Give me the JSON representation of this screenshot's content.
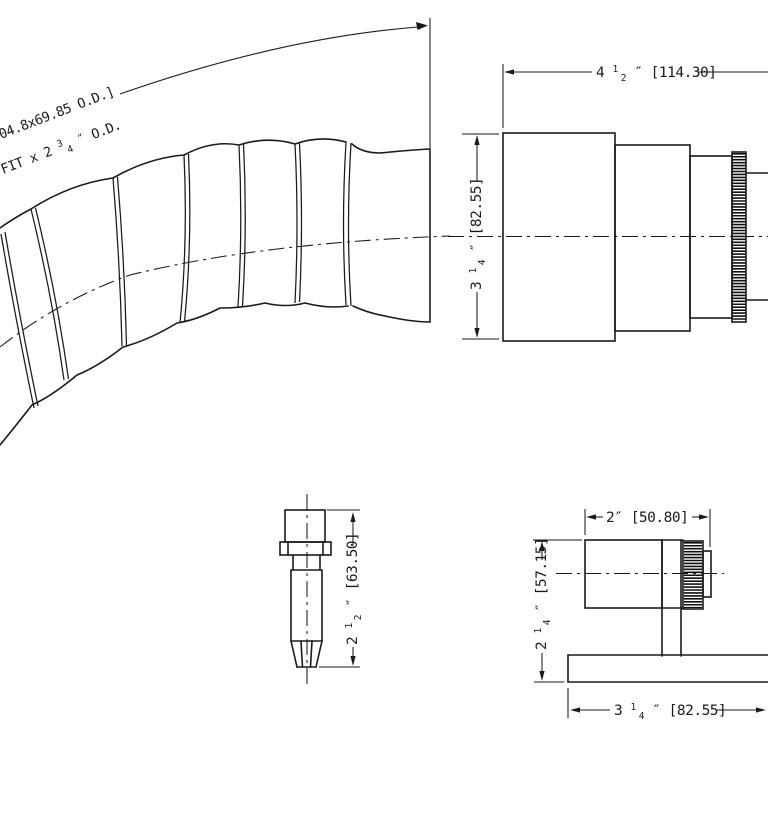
{
  "drawing": {
    "background": "#ffffff",
    "line_color": "#1a1a1a",
    "views": [
      "flexible-corrugated-hose",
      "fitting-side-view",
      "nozzle-fitting-view",
      "mounted-fitting-view"
    ]
  },
  "note": {
    "line1": "04.8x69.85 O.D.]",
    "line2_prefix": "FIT x 2",
    "frac_num": "3",
    "frac_den": "4",
    "line2_suffix": "″ O.D."
  },
  "dims": {
    "fitting_width": {
      "whole": "4",
      "num": "1",
      "den": "2",
      "rest": "″ [114.30]"
    },
    "fitting_height": {
      "whole": "3",
      "num": "1",
      "den": "4",
      "rest": "″ [82.55]"
    },
    "nozzle_height": {
      "whole": "2",
      "num": "1",
      "den": "2",
      "rest": "″ [63.50]"
    },
    "mount_width": {
      "text": "2″ [50.80]"
    },
    "mount_height": {
      "whole": "2",
      "num": "1",
      "den": "4",
      "rest": "″ [57.15]"
    },
    "base_width": {
      "whole": "3",
      "num": "1",
      "den": "4",
      "rest": "″ [82.55]"
    }
  }
}
